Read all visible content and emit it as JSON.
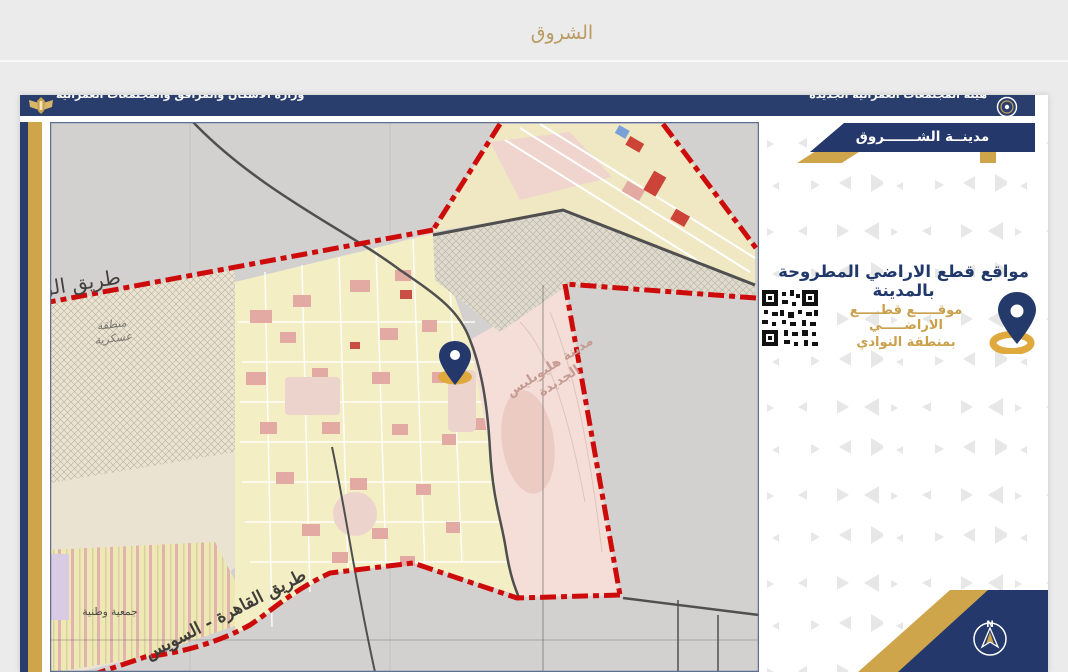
{
  "page": {
    "title": "الشروق",
    "theme": {
      "navy": "#2a3e6e",
      "gold": "#cfa54c",
      "red": "#ce0b0b",
      "page_bg": "#ecebeb",
      "title_color": "#b89b62"
    }
  },
  "doc": {
    "header": {
      "ministry": "وزارة الاسكان والمرافق والمجتمعات العمرانية",
      "authority": "هيئة المجتمعات العمرانية الجديدة",
      "eagle_icon": "egypt-eagle-emblem",
      "logo_icon": "nuca-circular-logo"
    },
    "city_banner": "مدينــة الشـــــــروق",
    "sidebar": {
      "title": "مواقع قطع الاراضي المطروحة بالمدينة",
      "qr_icon": "qr-code",
      "pin_icon": "map-location-pin",
      "location_line1": "موقـــــع قطـــــع الاراضـــــي",
      "location_line2": "بمنطقة النوادي",
      "compass_n": "N"
    },
    "map": {
      "labels": {
        "road_left": "طريق الق",
        "military_l1": "منطقة",
        "military_l2": "عسكرية",
        "heliopolis_l1": "مدينة هليوبليس",
        "heliopolis_l2": "الجديدة",
        "cairo_suez": "طريق القاهرة - السويس",
        "association": "جمعية وطنية"
      }
    }
  }
}
